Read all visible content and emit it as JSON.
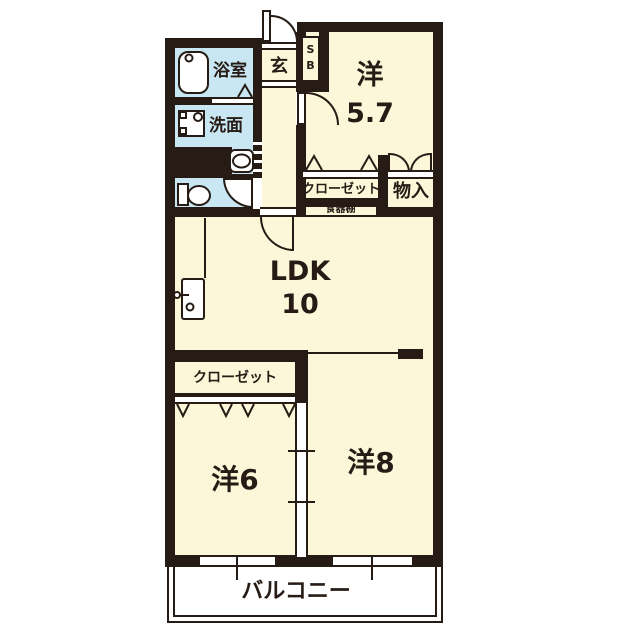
{
  "floorplan": {
    "labels": {
      "bathroom": "浴室",
      "entrance": "玄",
      "shoe_box_s": "S",
      "shoe_box_b": "B",
      "washroom": "洗面",
      "room57_kanji": "洋",
      "room57_size": "5.7",
      "closet_upper": "クローゼット",
      "storage": "物入",
      "cupboard": "食器棚",
      "ldk": "LDK",
      "ldk_size": "10",
      "closet_lower": "クローゼット",
      "room6": "洋6",
      "room8": "洋8",
      "balcony": "バルコニー"
    },
    "colors": {
      "wall": "#261b15",
      "floor_cream": "#fbf7d8",
      "floor_wet_blue": "#c9e7f2",
      "white": "#ffffff"
    },
    "fixtures": [
      "bathtub",
      "washing-machine",
      "wash-basin",
      "toilet",
      "kitchen-sink"
    ]
  }
}
